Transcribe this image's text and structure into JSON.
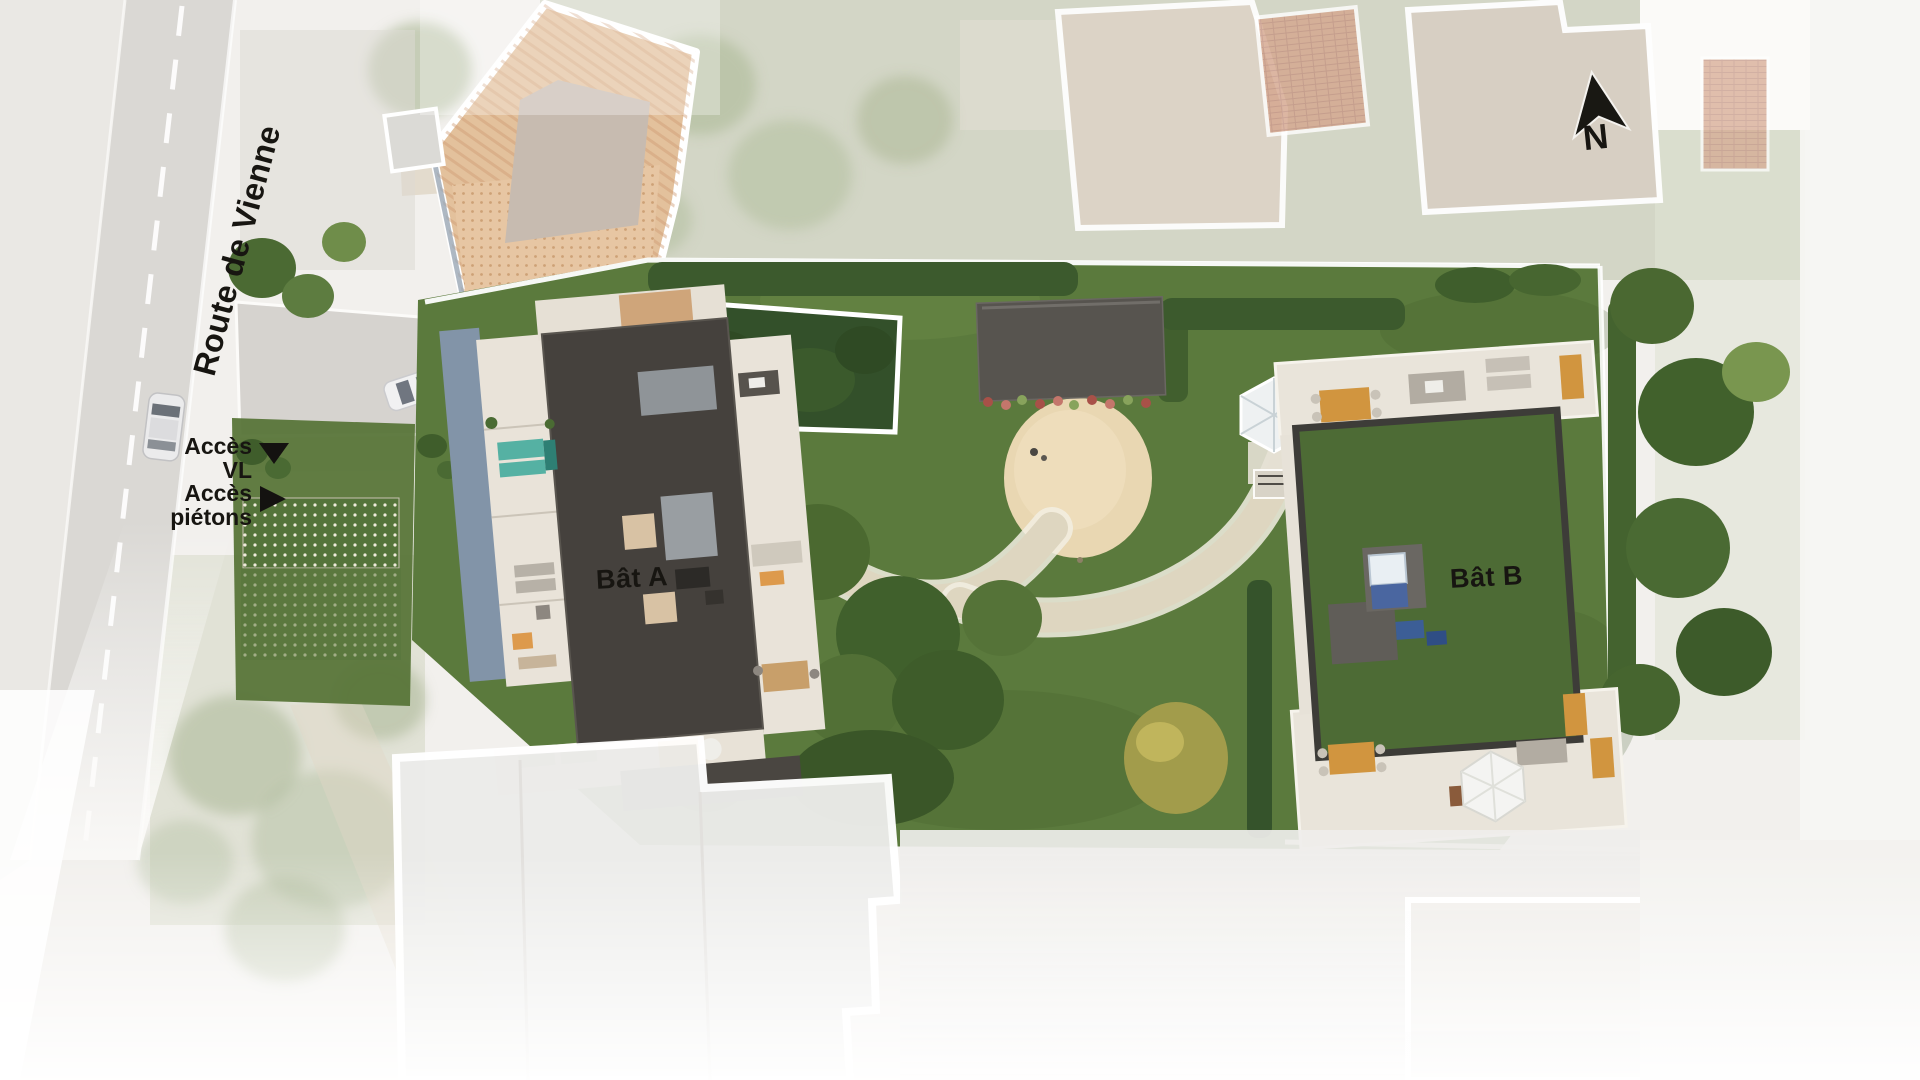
{
  "road": {
    "name": "Route de Vienne"
  },
  "access_points": [
    {
      "label_line1": "Accès",
      "label_line2": "VL",
      "marker": "triangle-down-icon"
    },
    {
      "label_line1": "Accès",
      "label_line2": "piétons",
      "marker": "triangle-right-icon"
    }
  ],
  "buildings": [
    {
      "label": "Bât A",
      "roof": "dark-flat-roof"
    },
    {
      "label": "Bât B",
      "roof": "green-planted-roof"
    }
  ],
  "compass": {
    "north_label": "N"
  },
  "colors": {
    "lawn": "#5b7a3d",
    "hedge": "#3b5a2c",
    "building_a_roof": "#45413d",
    "building_b_green_roof": "#4d6b35",
    "terrace_paving": "#e9e3d9",
    "road_asphalt": "#dad8d4",
    "sand_area": "#e9d7b2",
    "existing_roof_terracotta": "#e3c19c",
    "accent_orange_furniture": "#d1953f",
    "accent_teal_furniture": "#55b1a3",
    "north_arrow": "#191813"
  }
}
